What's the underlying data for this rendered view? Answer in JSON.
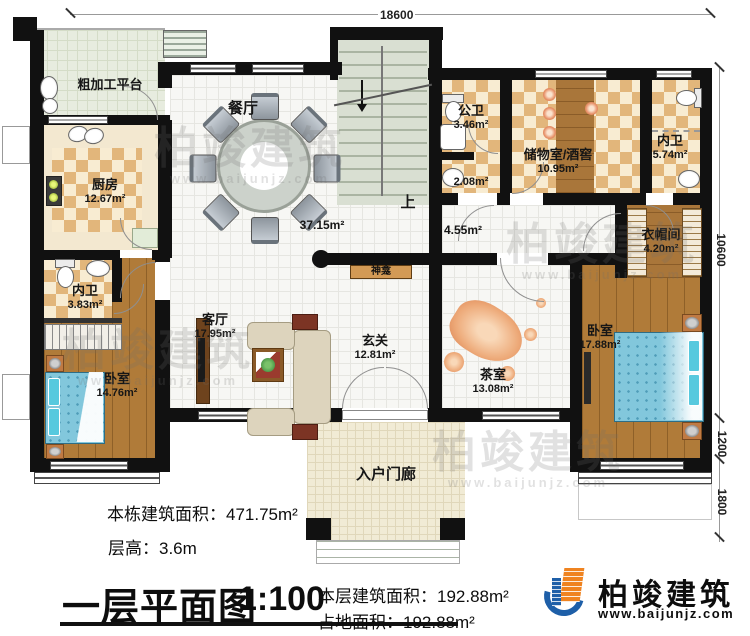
{
  "dimensions": {
    "top": "18600",
    "right_total": "10600",
    "right_bay": "1200",
    "right_porch": "1800"
  },
  "rooms": {
    "platform": {
      "name": "粗加工平台"
    },
    "kitchen": {
      "name": "厨房",
      "area": "12.67m²"
    },
    "bath_left": {
      "name": "内卫",
      "area": "3.83m²"
    },
    "bedroom_left": {
      "name": "卧室",
      "area": "14.76m²"
    },
    "dining": {
      "name": "餐厅",
      "area": "37.15m²"
    },
    "living": {
      "name": "客厅",
      "area": "17.95m²"
    },
    "foyer": {
      "name": "玄关",
      "area": "12.81m²"
    },
    "hallway": {
      "area": "4.55m²"
    },
    "public_bath": {
      "name": "公卫",
      "area": "3.46m²"
    },
    "wash": {
      "area": "2.08m²"
    },
    "storage": {
      "name": "储物室/酒窖",
      "area": "10.95m²"
    },
    "bath_right": {
      "name": "内卫",
      "area": "5.74m²"
    },
    "cloakroom": {
      "name": "衣帽间",
      "area": "4.20m²"
    },
    "bedroom_right": {
      "name": "卧室",
      "area": "17.88m²"
    },
    "tea_room": {
      "name": "茶室",
      "area": "13.08m²"
    },
    "porch": {
      "name": "入户门廊"
    }
  },
  "annotations": {
    "stairs_up": "上",
    "shrine": "神龛"
  },
  "footer": {
    "total_area": "本栋建筑面积：471.75m²",
    "floor_height": "层高：3.6m",
    "plan_title": "一层平面图",
    "scale": "1:100",
    "floor_area": "本层建筑面积：192.88m²",
    "land_area": "占地面积：192.88m²"
  },
  "branding": {
    "company": "柏竣建筑",
    "website": "www.baijunjz.com"
  },
  "watermark": {
    "text": "柏竣建筑",
    "site": "www.baijunjz.com"
  }
}
